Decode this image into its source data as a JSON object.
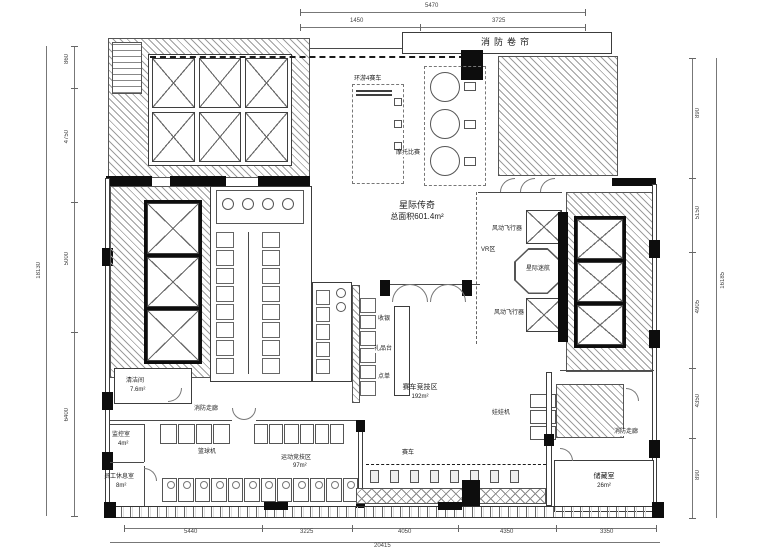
{
  "plan": {
    "title": "星际传奇",
    "area": "总面积601.4m²"
  },
  "labels": {
    "fire_shutter": "消防卷帘",
    "racing4": "环游4赛车",
    "moto_race": "摩托比赛",
    "vr_zone": "VR区",
    "wind_flyer_top": "风动飞行器",
    "star_trek": "星际迷航",
    "wind_flyer_bottom": "风动飞行器",
    "cashier": "收银",
    "gift_counter": "礼品台",
    "order_point": "点单",
    "racing_zone": "赛车竞技区",
    "racing_zone_area": "192m²",
    "race_car": "赛车",
    "claw_machine": "娃娃机",
    "fire_corridor_right": "消防走廊",
    "storage_room": "储藏室",
    "storage_area": "26m²",
    "cleaning_room": "清洁间",
    "cleaning_area": "7.6m²",
    "fire_corridor_left": "消防走廊",
    "monitor_room": "监控室",
    "monitor_area": "4m²",
    "staff_room": "员工休息室",
    "staff_area": "8m²",
    "basketball_machine": "篮球机",
    "sports_zone": "运动竞技区",
    "sports_area": "97m²"
  },
  "dims": {
    "top_total": "5470",
    "top": [
      "1450",
      "3725"
    ],
    "left_total": "18130",
    "left": [
      "860",
      "4750",
      "5000",
      "6400"
    ],
    "right_total": "16185",
    "right": [
      "890",
      "5150",
      "4905",
      "4350",
      "890"
    ],
    "bottom_total": "20415",
    "bottom": [
      "5440",
      "3225",
      "4050",
      "4350",
      "3350"
    ]
  },
  "counts": {
    "top_left_elevators": 6,
    "left_elevators": 3,
    "right_elevators": 3,
    "racing4_units": 2,
    "moto_units": 3,
    "basketball_left": 4,
    "basketball_right": 6,
    "sports_units": 12,
    "race_seats": 8,
    "claw_units": 3,
    "stalls_left": 8,
    "stalls_right": 8,
    "shelf_cells": 6,
    "fixture_cells": 5
  }
}
